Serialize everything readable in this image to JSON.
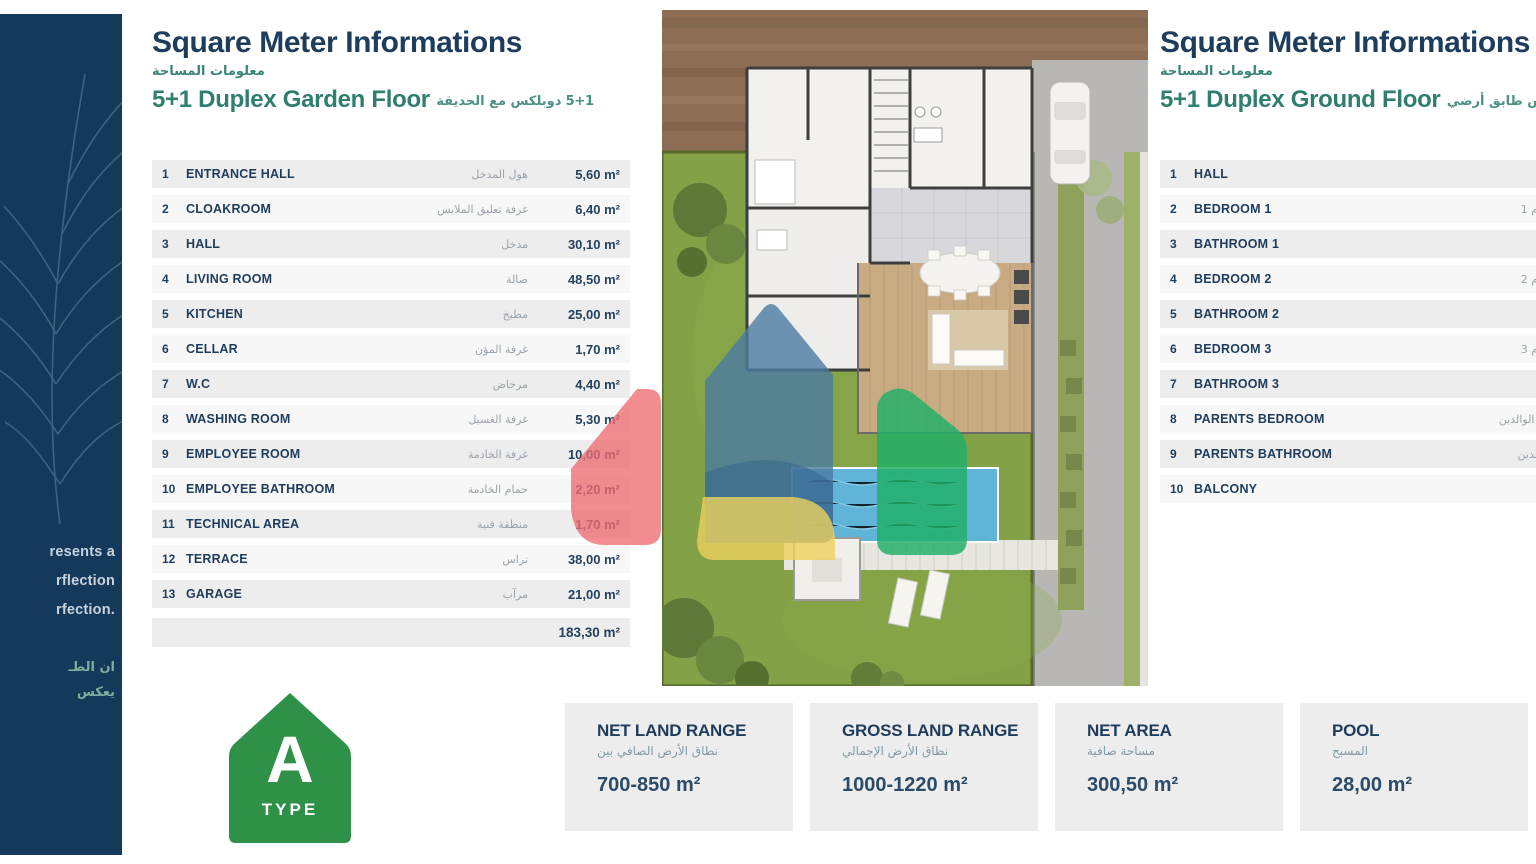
{
  "sidebar": {
    "line1": "resents a",
    "line2": "rflection",
    "line3": "rfection.",
    "ar_line1": "ان الطـ",
    "ar_line2": "يعكس"
  },
  "left_panel": {
    "title": "Square Meter Informations",
    "title_ar": "معلومات المساحة",
    "subtitle": "5+1 Duplex Garden Floor",
    "subtitle_ar": "5+1 دوبلكس مع الحديقة",
    "rows": [
      {
        "num": "1",
        "label": "ENTRANCE HALL",
        "ar": "هول المدخل",
        "value": "5,60 m²"
      },
      {
        "num": "2",
        "label": "CLOAKROOM",
        "ar": "غرفة تعليق الملابس",
        "value": "6,40 m²"
      },
      {
        "num": "3",
        "label": "HALL",
        "ar": "مدخل",
        "value": "30,10 m²"
      },
      {
        "num": "4",
        "label": "LIVING ROOM",
        "ar": "صالة",
        "value": "48,50 m²"
      },
      {
        "num": "5",
        "label": "KITCHEN",
        "ar": "مطبخ",
        "value": "25,00 m²"
      },
      {
        "num": "6",
        "label": "CELLAR",
        "ar": "غرفة المؤن",
        "value": "1,70 m²"
      },
      {
        "num": "7",
        "label": "W.C",
        "ar": "مرحاض",
        "value": "4,40 m²"
      },
      {
        "num": "8",
        "label": "WASHING ROOM",
        "ar": "غرفة الغسيل",
        "value": "5,30 m²"
      },
      {
        "num": "9",
        "label": "EMPLOYEE ROOM",
        "ar": "غرفة الخادمة",
        "value": "10,00 m²"
      },
      {
        "num": "10",
        "label": "EMPLOYEE BATHROOM",
        "ar": "حمام الخادمة",
        "value": "2,20 m²"
      },
      {
        "num": "11",
        "label": "TECHNICAL AREA",
        "ar": "منطقة فنية",
        "value": "1,70 m²"
      },
      {
        "num": "12",
        "label": "TERRACE",
        "ar": "تراس",
        "value": "38,00 m²"
      },
      {
        "num": "13",
        "label": "GARAGE",
        "ar": "مرآب",
        "value": "21,00 m²"
      }
    ],
    "total": "183,30 m²"
  },
  "right_panel": {
    "title": "Square Meter Informations",
    "title_ar": "معلومات المساحة",
    "subtitle": "5+1 Duplex Ground Floor",
    "subtitle_ar": "5+1 دوبلكس طابق أرضي",
    "rows": [
      {
        "num": "1",
        "label": "HALL",
        "ar": "مدخل"
      },
      {
        "num": "2",
        "label": "BEDROOM 1",
        "ar": "غرفة النوم 1"
      },
      {
        "num": "3",
        "label": "BATHROOM 1",
        "ar": "حمام 1"
      },
      {
        "num": "4",
        "label": "BEDROOM 2",
        "ar": "غرفة النوم 2"
      },
      {
        "num": "5",
        "label": "BATHROOM 2",
        "ar": "حمام 2"
      },
      {
        "num": "6",
        "label": "BEDROOM 3",
        "ar": "غرفة النوم 3"
      },
      {
        "num": "7",
        "label": "BATHROOM 3",
        "ar": "حمام 3"
      },
      {
        "num": "8",
        "label": "PARENTS BEDROOM",
        "ar": "غرفة نوم الوالدين"
      },
      {
        "num": "9",
        "label": "PARENTS BATHROOM",
        "ar": "حمام الوالدين"
      },
      {
        "num": "10",
        "label": "BALCONY",
        "ar": "شرفة"
      }
    ]
  },
  "type_badge": {
    "letter": "A",
    "label": "TYPE"
  },
  "info_boxes": [
    {
      "title": "NET LAND RANGE",
      "ar": "نطاق الأرض الصافي بين",
      "value": "700-850 m²"
    },
    {
      "title": "GROSS LAND RANGE",
      "ar": "نطاق الأرض الإجمالي",
      "value": "1000-1220 m²"
    },
    {
      "title": "NET AREA",
      "ar": "مساحة صافية",
      "value": "300,50 m²"
    },
    {
      "title": "POOL",
      "ar": "المسبح",
      "value": "28,00 m²"
    }
  ],
  "colors": {
    "navy": "#1e3c5c",
    "teal": "#2f7e6e",
    "sidebar_navy": "#14395b",
    "row_gray": "#ededed",
    "badge_green": "#2f9148",
    "logo_red": "#ed6b72",
    "logo_blue": "#4a7ba1",
    "logo_green": "#1fae66",
    "logo_yellow": "#ecd15c",
    "pool_blue": "#5fb4d8",
    "garden_green": "#83a146",
    "dirt_brown": "#8d6e55"
  }
}
